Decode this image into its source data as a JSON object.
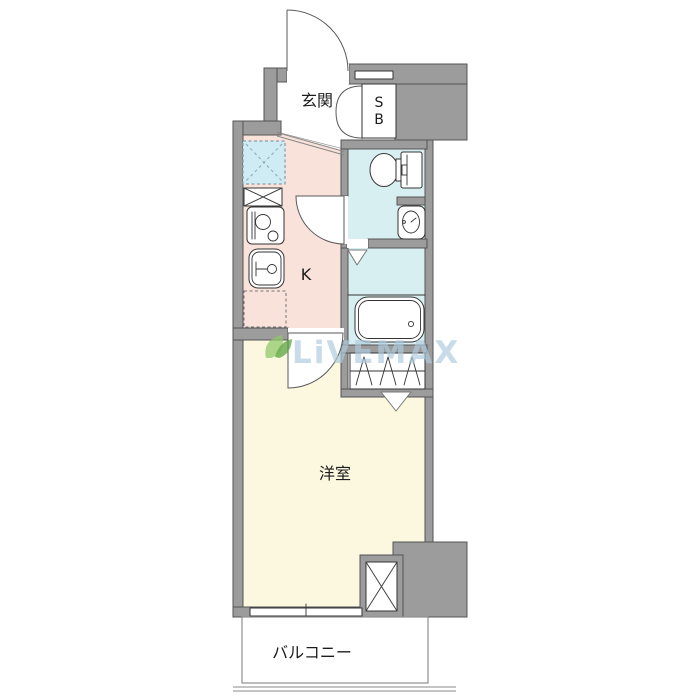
{
  "plan_type": "apartment-floor-plan",
  "labels": {
    "entrance": "玄関",
    "shoe_box_line1": "S",
    "shoe_box_line2": "B",
    "kitchen": "K",
    "western_room": "洋室",
    "balcony": "バルコニー"
  },
  "watermark": {
    "text": "LiVEMAX"
  },
  "rooms": [
    {
      "name": "entrance",
      "label": "玄関"
    },
    {
      "name": "shoe-box",
      "label": "SB"
    },
    {
      "name": "kitchen",
      "label": "K"
    },
    {
      "name": "toilet-room",
      "label": ""
    },
    {
      "name": "bathroom",
      "label": ""
    },
    {
      "name": "closet",
      "label": ""
    },
    {
      "name": "western-room",
      "label": "洋室"
    },
    {
      "name": "balcony",
      "label": "バルコニー"
    }
  ],
  "icons": [
    "toilet-fixture",
    "washbasin-fixture",
    "bathtub-fixture",
    "gas-stove-fixture",
    "kitchen-sink-fixture",
    "refrigerator-space-x",
    "pipe-space-x",
    "counter-space-dashed",
    "entrance-door-arc",
    "toilet-door-arc",
    "room-door-arc",
    "shoebox-bifold-doors",
    "closet-folding-hatch",
    "door-triangle-marker",
    "window-slot",
    "balcony-window-tick",
    "leaf-logo"
  ],
  "colors": {
    "background": "#ffffff",
    "wall_fill": "#9c9c9c",
    "wall_stroke": "#545454",
    "kitchen_floor": "#f9e2da",
    "wet_area_floor": "#d8eff2",
    "room_floor": "#fbf8df",
    "refrigerator_space": "#cfecf4",
    "fixture_stroke": "#333333",
    "watermark_text": "#aecbdf",
    "watermark_leaf": "#6aaf3d"
  }
}
